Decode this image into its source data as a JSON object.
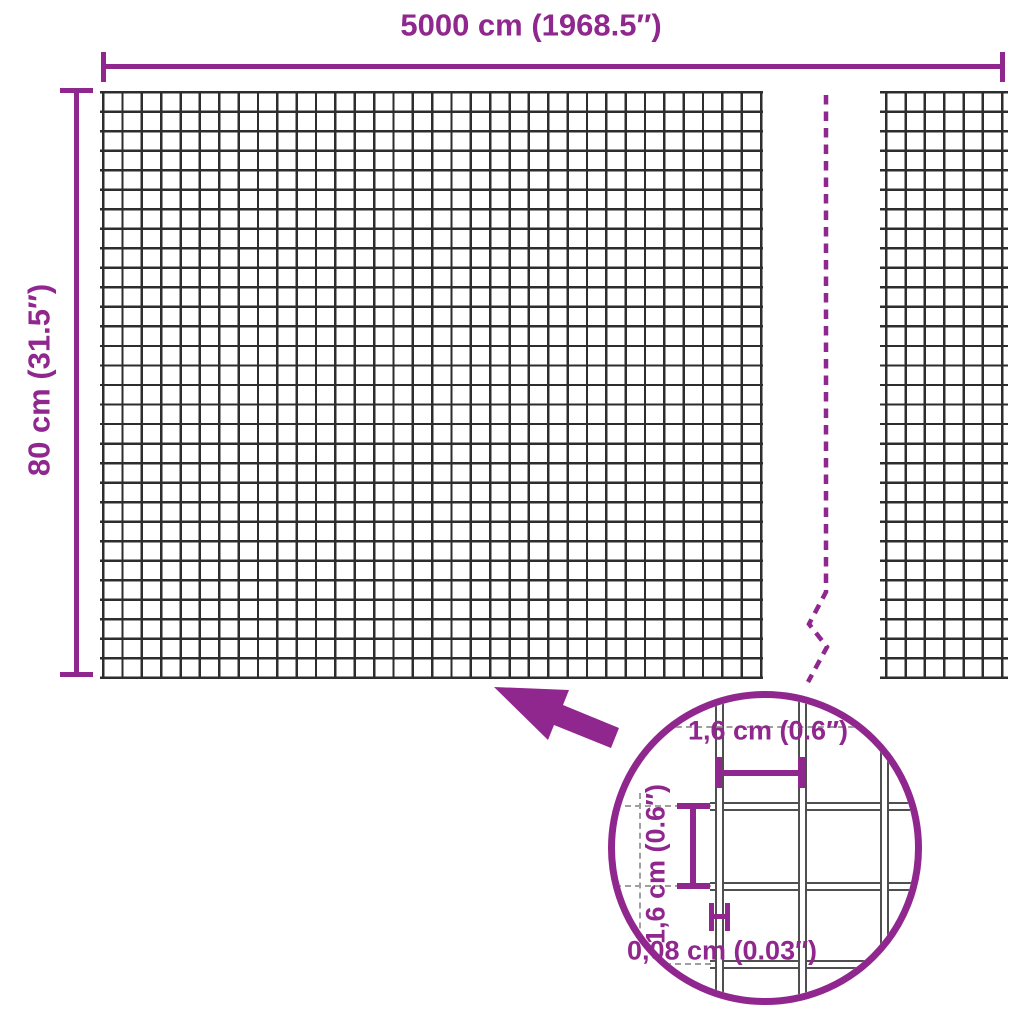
{
  "diagram": {
    "width_dimension": {
      "label": "5000 cm (1968.5″)"
    },
    "height_dimension": {
      "label": "80 cm (31.5″)"
    },
    "detail": {
      "mesh_opening_width": {
        "label": "1,6 cm (0.6″)"
      },
      "mesh_opening_height": {
        "label": "1,6 cm (0.6″)"
      },
      "wire_thickness": {
        "label": "0,08 cm (0.03″)"
      }
    }
  },
  "icons": {
    "detail_arrow": "arrow-pointing-upper-left",
    "magnifier_circle": "zoom-detail-circle",
    "break_line": "panel-break-dashed-line"
  },
  "colors": {
    "accent": "#90278E",
    "mesh_wire": "#2d2d2d",
    "detail_wire": "#4f4f4f",
    "detail_dash": "#9f9f9f"
  }
}
